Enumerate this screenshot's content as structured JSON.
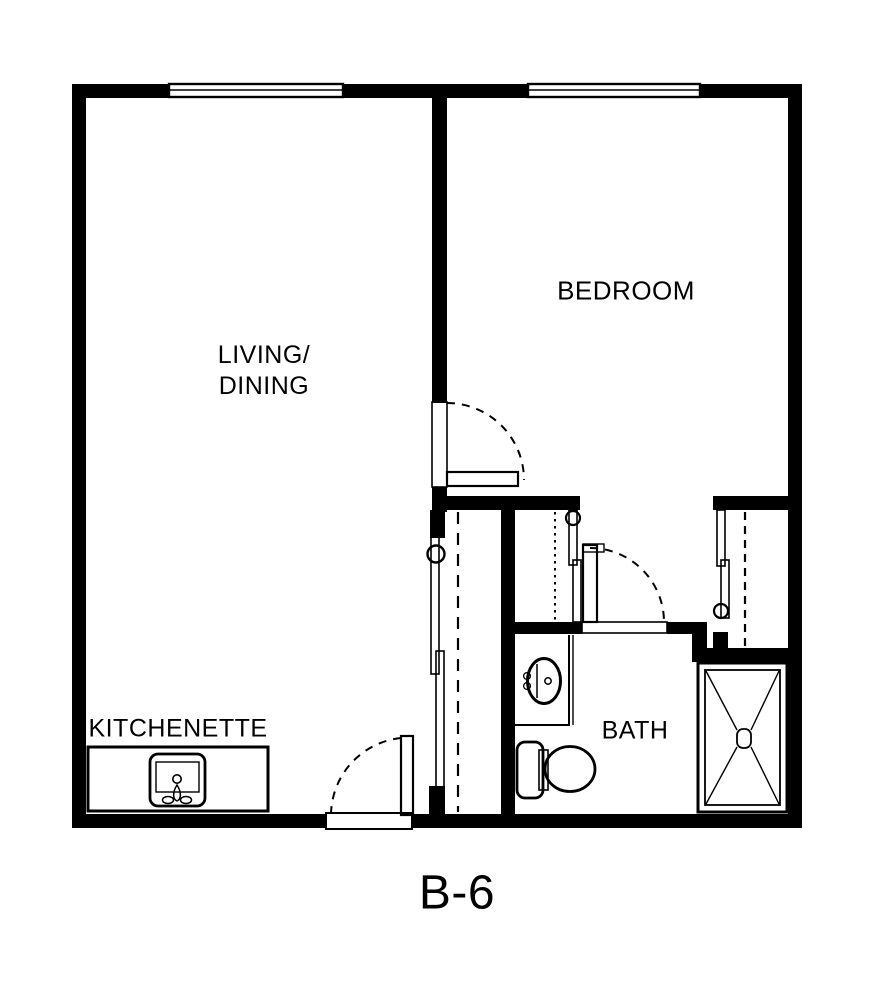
{
  "plan": {
    "title": "B-6",
    "colors": {
      "wall": "#000000",
      "floor": "#ffffff"
    },
    "rooms": [
      {
        "id": "living-dining",
        "lines": [
          "LIVING/",
          "DINING"
        ]
      },
      {
        "id": "bedroom",
        "label": "BEDROOM"
      },
      {
        "id": "kitchenette",
        "label": "KITCHENETTE"
      },
      {
        "id": "bath",
        "label": "BATH"
      }
    ],
    "fixtures": [
      {
        "icon": "kitchen-sink-icon",
        "room": "kitchenette"
      },
      {
        "icon": "vanity-sink-icon",
        "room": "bath"
      },
      {
        "icon": "toilet-icon",
        "room": "bath"
      },
      {
        "icon": "shower-icon",
        "room": "bath"
      },
      {
        "icon": "window-icon",
        "room": "living-dining"
      },
      {
        "icon": "window-icon",
        "room": "bedroom"
      },
      {
        "icon": "swing-door-icon",
        "room": "living-dining"
      },
      {
        "icon": "swing-door-icon",
        "room": "bedroom"
      },
      {
        "icon": "swing-door-icon",
        "room": "bath"
      },
      {
        "icon": "sliding-closet-door-icon",
        "room": "living-dining"
      },
      {
        "icon": "sliding-closet-door-icon",
        "room": "hall"
      },
      {
        "icon": "sliding-closet-door-icon",
        "room": "bedroom"
      }
    ]
  }
}
